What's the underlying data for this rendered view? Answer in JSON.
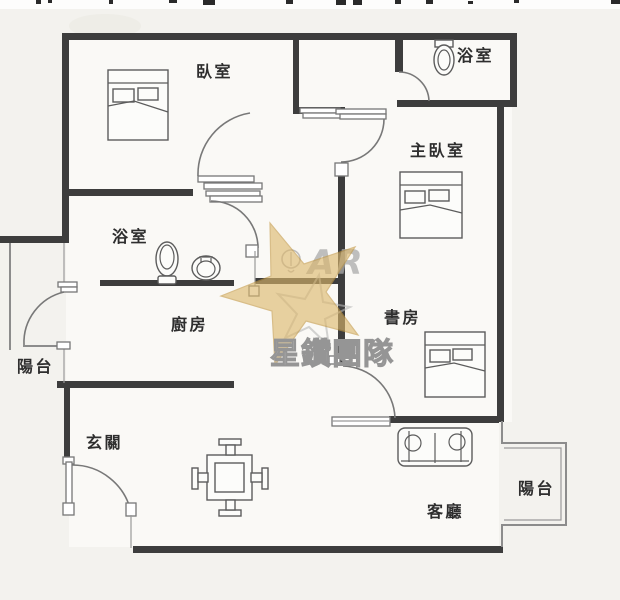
{
  "plan": {
    "rooms": {
      "bedroom": "臥室",
      "bathroom_upper": "浴室",
      "master_bedroom": "主臥室",
      "bathroom_middle": "浴室",
      "kitchen": "廚房",
      "study": "書房",
      "balcony_left": "陽台",
      "entry_hall": "玄關",
      "living_room": "客廳",
      "balcony_right": "陽台"
    }
  },
  "watermark": {
    "team_name": "星鑽團隊",
    "logo_letters": "AR",
    "star_color": "#dcb76b"
  },
  "colors": {
    "background": "#f3f2ee",
    "wall": "#3d3d3d",
    "thin_line": "#8c8c8c",
    "label_text": "#2e2e2e",
    "watermark_gray": "#b5b5b5"
  }
}
